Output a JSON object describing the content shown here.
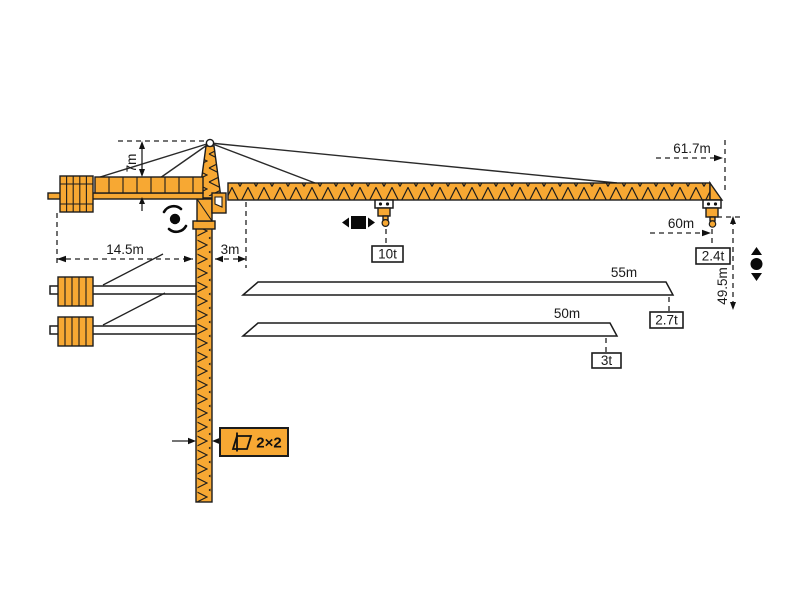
{
  "diagram": {
    "type": "tower-crane-specification-drawing",
    "dims": {
      "head_height": "7m",
      "counter_radius": "14.5m",
      "mast_to_jib_offset": "3m",
      "max_radius": "61.7m",
      "radius_at_tip_load": "60m",
      "hook_height": "49.5m",
      "mast_section": "2×2"
    },
    "loads": {
      "max": "10t",
      "tip_main": "2.4t",
      "tip_55": "2.7t",
      "tip_50": "3t"
    },
    "variants": {
      "jib_55": "55m",
      "jib_50": "50m"
    },
    "colors": {
      "crane": "#F7A833",
      "outline": "#1c1c1c"
    },
    "icons": [
      "slew-rotation-icon",
      "trolley-travel-icon",
      "hoist-icon",
      "mast-cross-section-icon"
    ]
  }
}
